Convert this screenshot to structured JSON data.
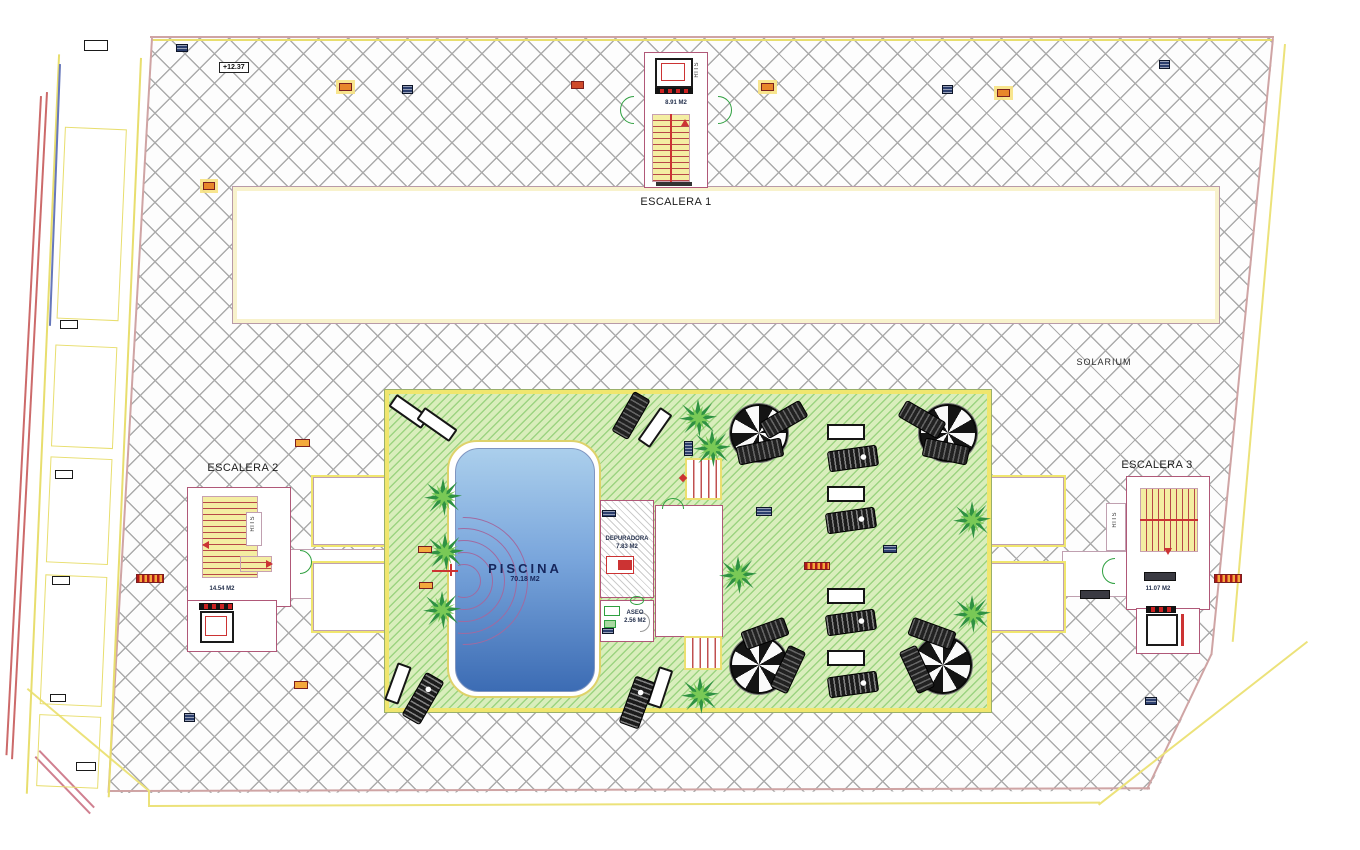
{
  "drawing": {
    "solarium": "SOLARIUM",
    "level_marker": "+12.37",
    "pool": {
      "name": "PISCINA",
      "area": "70.18 M2"
    },
    "stairs1": {
      "name": "ESCALERA 1",
      "area": "8.91 M2",
      "riser_label": "RITS"
    },
    "stairs2": {
      "name": "ESCALERA 2",
      "area": "14.54 M2",
      "riser_label": "RITS"
    },
    "stairs3": {
      "name": "ESCALERA 3",
      "area": "11.07 M2",
      "riser_label": "RITS"
    },
    "depuradora": {
      "name": "DEPURADORA",
      "area": "7.83 M2"
    },
    "aseo": {
      "name": "ASEO",
      "area": "2.56 M2"
    },
    "colors": {
      "deck_green": "#d9eebc",
      "deck_hatch_line": "#6abe50",
      "paving_hatch_line": "#ababab",
      "pool_blue_top": "#abcfec",
      "pool_blue_bottom": "#3c6cb4",
      "border_yellow": "#f0e66e",
      "wall_pink": "#b05878",
      "accent_red": "#cc3333",
      "marker_orange": "#f4a93c",
      "marker_navy": "#2c3f6e"
    }
  }
}
